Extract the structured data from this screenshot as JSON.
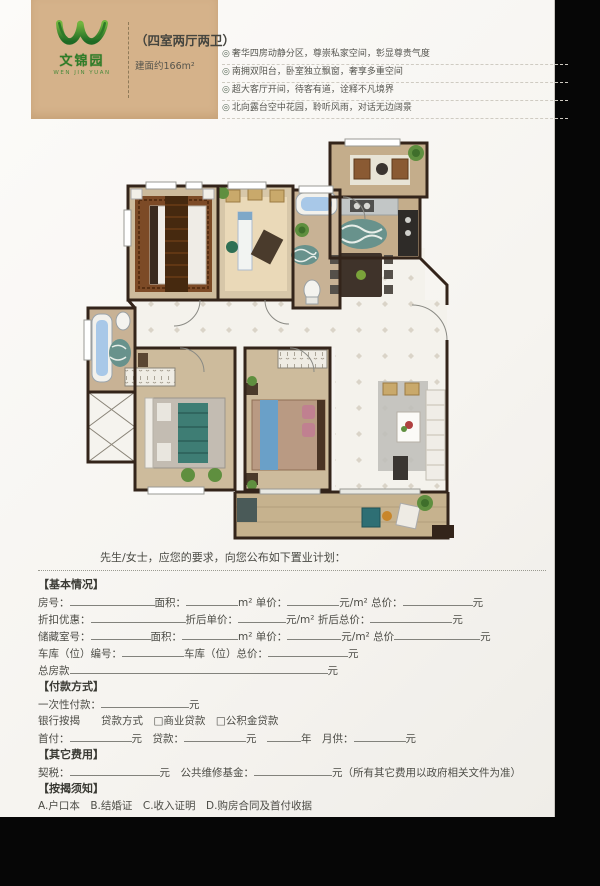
{
  "colors": {
    "bg": "#060606",
    "paper": "#faf9f6",
    "tan": "#d5b28a",
    "brand-green": "#3c8a2e",
    "text": "#4c4c46",
    "line": "#82827c",
    "dash": "#cfcbc2",
    "wall": "#33241a",
    "wood": "#cdbb9c",
    "tile": "#f4f2ec"
  },
  "header": {
    "brand_cn": "文锦园",
    "brand_en": "WEN JIN YUAN",
    "title": "（四室两厅两卫）",
    "area": "建面约166m²"
  },
  "features": {
    "bullet": "◎",
    "items": [
      "奢华四房动静分区，尊崇私家空间，彰显尊贵气度",
      "南拥双阳台，卧室独立飘窗，奢享多重空间",
      "超大客厅开间，待客有道，诠释不凡境界",
      "北向露台空中花园，聆听风雨，对话无边阔景"
    ]
  },
  "form": {
    "rows": [
      {
        "style": "intro",
        "segments": [
          {
            "g": 62
          },
          {
            "t": "先生/女士，应您的要求，向您公布如下置业计划："
          }
        ]
      },
      {
        "style": "divider",
        "segments": []
      },
      {
        "style": "header",
        "text": "【基本情况】",
        "segments": []
      },
      {
        "style": "fields",
        "segments": [
          {
            "t": "房号："
          },
          {
            "u": 85
          },
          {
            "t": "面积："
          },
          {
            "u": 52
          },
          {
            "t": "m² 单价："
          },
          {
            "u": 52
          },
          {
            "t": "元/m² 总价："
          },
          {
            "u": 70
          },
          {
            "t": "元"
          }
        ]
      },
      {
        "style": "fields",
        "segments": [
          {
            "t": "折扣优惠："
          },
          {
            "u": 95
          },
          {
            "t": "折后单价："
          },
          {
            "u": 48
          },
          {
            "t": "元/m² 折后总价："
          },
          {
            "u": 82
          },
          {
            "t": "元"
          }
        ]
      },
      {
        "style": "fields",
        "segments": [
          {
            "t": "储藏室号："
          },
          {
            "u": 60
          },
          {
            "t": "面积："
          },
          {
            "u": 56
          },
          {
            "t": "m² 单价："
          },
          {
            "u": 54
          },
          {
            "t": "元/m² 总价"
          },
          {
            "u": 86
          },
          {
            "t": "元"
          }
        ]
      },
      {
        "style": "fields",
        "segments": [
          {
            "t": "车库（位）编号："
          },
          {
            "u": 62
          },
          {
            "t": "车库（位）总价："
          },
          {
            "u": 80
          },
          {
            "t": "元"
          }
        ]
      },
      {
        "style": "fields",
        "segments": [
          {
            "t": "总房款"
          },
          {
            "u": 258
          },
          {
            "t": "元"
          }
        ]
      },
      {
        "style": "header",
        "text": "【付款方式】",
        "segments": []
      },
      {
        "style": "fields",
        "segments": [
          {
            "t": "一次性付款："
          },
          {
            "u": 88
          },
          {
            "t": "元"
          }
        ]
      },
      {
        "style": "fields",
        "segments": [
          {
            "t": "银行按揭　　贷款方式　□商业贷款　□公积金贷款"
          }
        ]
      },
      {
        "style": "fields",
        "segments": [
          {
            "t": "首付："
          },
          {
            "u": 62
          },
          {
            "t": "元　贷款："
          },
          {
            "u": 62
          },
          {
            "t": "元　"
          },
          {
            "u": 34
          },
          {
            "t": "年　月供："
          },
          {
            "u": 52
          },
          {
            "t": "元"
          }
        ]
      },
      {
        "style": "header",
        "text": "【其它费用】",
        "segments": []
      },
      {
        "style": "fields",
        "segments": [
          {
            "t": "契税："
          },
          {
            "u": 90
          },
          {
            "t": "元　公共维修基金："
          },
          {
            "u": 78
          },
          {
            "t": "元（所有其它费用以政府相关文件为准）"
          }
        ]
      },
      {
        "style": "header",
        "text": "【按揭须知】",
        "segments": []
      },
      {
        "style": "fields",
        "segments": [
          {
            "t": "A.户口本　B.结婚证　C.收入证明　D.购房合同及首付收据"
          }
        ]
      }
    ]
  }
}
